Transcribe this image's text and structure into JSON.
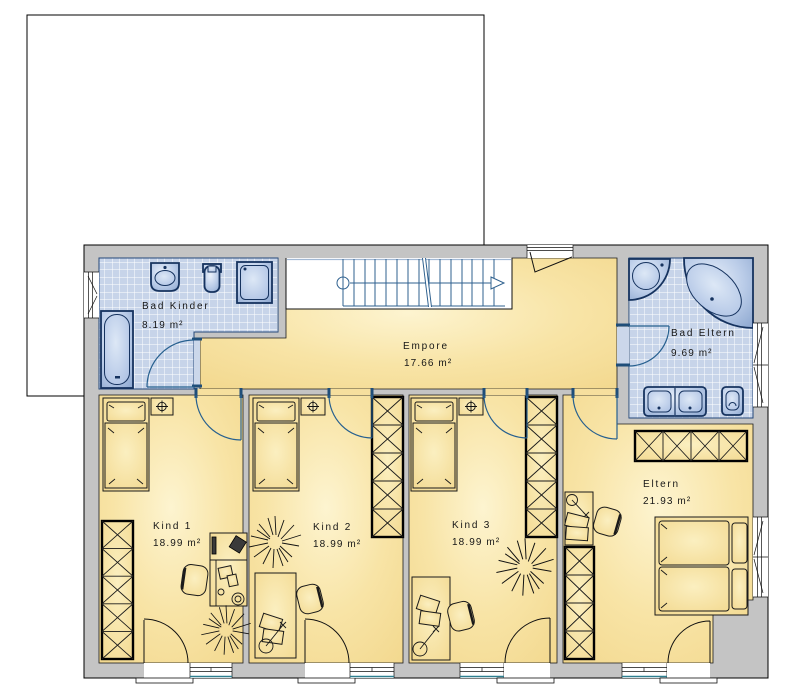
{
  "plan": {
    "type": "floor-plan-upper-storey",
    "rooms": [
      {
        "name": "Bad Kinder",
        "area": "8.19 m²"
      },
      {
        "name": "Empore",
        "area": "17.66 m²"
      },
      {
        "name": "Bad Eltern",
        "area": "9.69 m²"
      },
      {
        "name": "Kind 1",
        "area": "18.99 m²"
      },
      {
        "name": "Kind 2",
        "area": "18.99 m²"
      },
      {
        "name": "Kind 3",
        "area": "18.99 m²"
      },
      {
        "name": "Eltern",
        "area": "21.93 m²"
      }
    ],
    "stairs": {
      "treads": 15
    },
    "fixtures": [
      "bathtub",
      "corner-bathtub",
      "corner-shower",
      "shower",
      "washbasin",
      "double-washbasin",
      "toilet",
      "single-bed",
      "double-bed",
      "nightstand-lamp",
      "wardrobe",
      "desk",
      "chair",
      "plant"
    ],
    "colors": {
      "floor": "#F7E1A0",
      "floor_highlight": "#FDF4D0",
      "wall": "#C4C4C4",
      "tile": "#C7D4E9",
      "fixture": "#AFC3E4",
      "fixture_outline": "#16335F",
      "door_arc_interior": "#27608F",
      "door_arc_exterior": "#111111",
      "stair_lines": "#2F618F",
      "balcony_edge": "#2E7F8F"
    }
  }
}
